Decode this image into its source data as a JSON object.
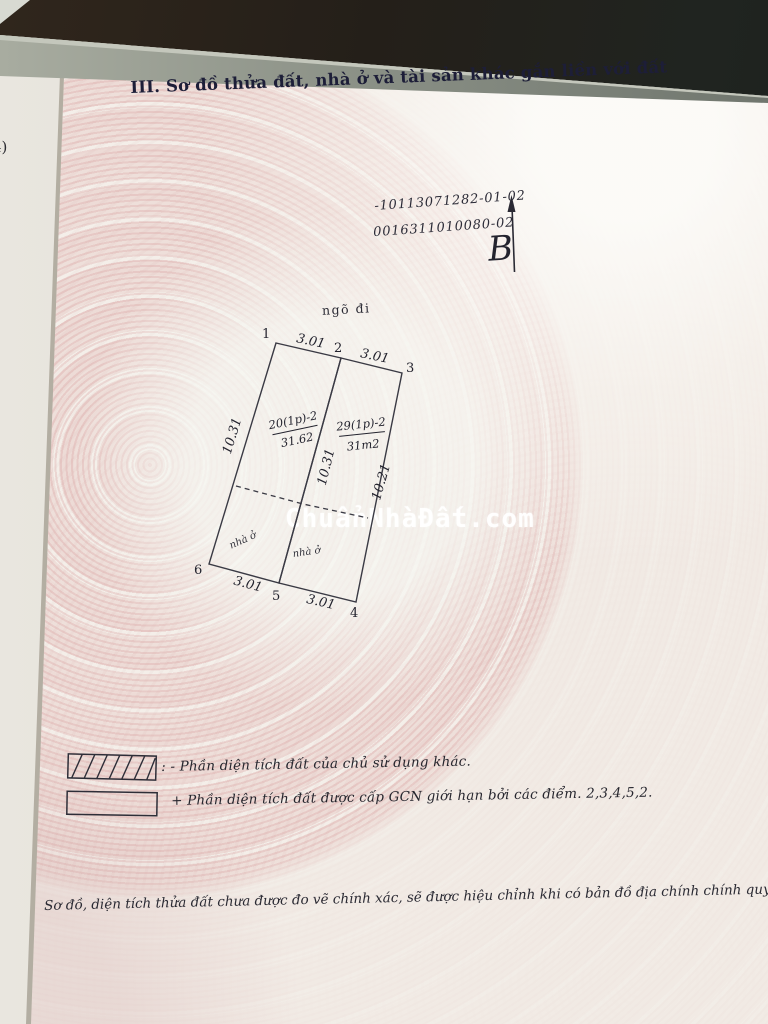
{
  "document": {
    "margin_note": "4)",
    "section_title": "III. Sơ đồ thửa đất, nhà ở và tài sản khác gắn liền với đất",
    "certificate_numbers": {
      "line1": "-10113071282-01-02",
      "line2": "0016311010080-02"
    },
    "north_arrow_label": "B",
    "watermark": "ChuẩnNhàĐất.com",
    "footer_note": "Sơ đồ, diện tích thửa đất chưa được đo vẽ chính xác, sẽ được hiệu chỉnh khi có bản đồ địa chính chính quy."
  },
  "diagram": {
    "alley_label": "ngõ đi",
    "vertex_labels": {
      "v1": "1",
      "v2": "2",
      "v3": "3",
      "v4": "4",
      "v5": "5",
      "v6": "6"
    },
    "edge_labels": {
      "top_left": "3.01",
      "top_right": "3.01",
      "bottom_left": "3.01",
      "bottom_right": "3.01",
      "left_side": "10.31",
      "middle": "10.31",
      "right_side": "10.21"
    },
    "other_owner_plot": {
      "parcel": "20(1p)-2",
      "area": "31.62",
      "house_label": "nhà ở"
    },
    "granted_plot": {
      "parcel": "29(1p)-2",
      "area": "31m2",
      "house_label": "nhà ở"
    }
  },
  "legend": {
    "items": [
      {
        "symbol": "hatched-box",
        "text": ": - Phần diện tích đất của chủ sử dụng khác."
      },
      {
        "symbol": "empty-box",
        "text": "+ Phần diện tích đất được cấp GCN giới hạn bởi các điểm. 2,3,4,5,2."
      }
    ]
  },
  "colors": {
    "paper": "#f1ebe4",
    "pattern_pink": "#e0acac",
    "ink": "#23232e",
    "title_ink": "#1d1e38",
    "table_dark": "#241f19",
    "watermark": "#ffffff"
  }
}
